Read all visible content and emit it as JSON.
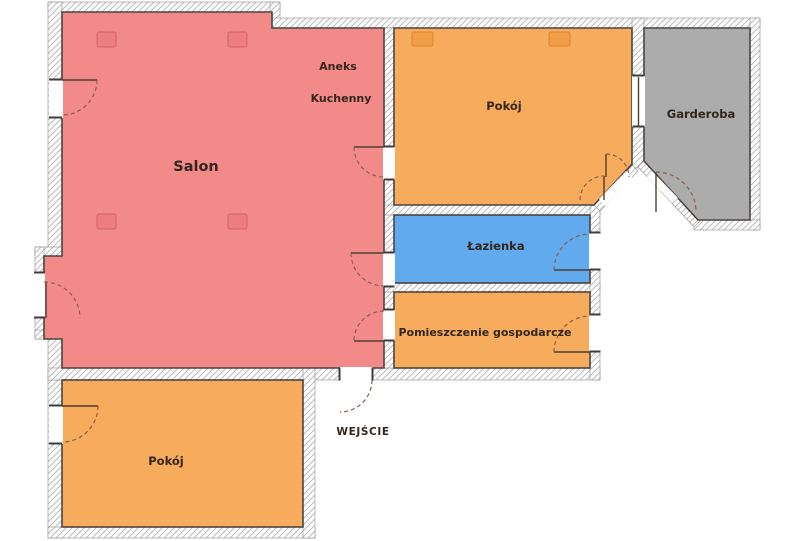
{
  "plan": {
    "labels": {
      "salon": "Salon",
      "aneks_line1": "Aneks",
      "aneks_line2": "Kuchenny",
      "room_top": "Pokój",
      "wardrobe": "Garderoba",
      "bathroom": "Łazienka",
      "utility": "Pomieszczenie gospodarcze",
      "room_bottom": "Pokój",
      "entrance": "WEJŚCIE"
    },
    "colors": {
      "background": "#ffffff",
      "salon": "#f28a8a",
      "room": "#f6ac5c",
      "bathroom": "#62aaee",
      "wardrobe": "#acacac",
      "room_border": "#4a4440",
      "wall_edge": "#8f8f8f",
      "hatch_line": "#bdbdbd",
      "door_leaf": "#4e3d30",
      "door_arc": "#8b5f4d",
      "tick": "#3d3d3d",
      "label_text": "#33261c",
      "salon_marker": "#ee7e7e",
      "salon_marker_border": "#cf6767",
      "room_marker": "#f29d47",
      "room_marker_border": "#d8862e"
    }
  }
}
